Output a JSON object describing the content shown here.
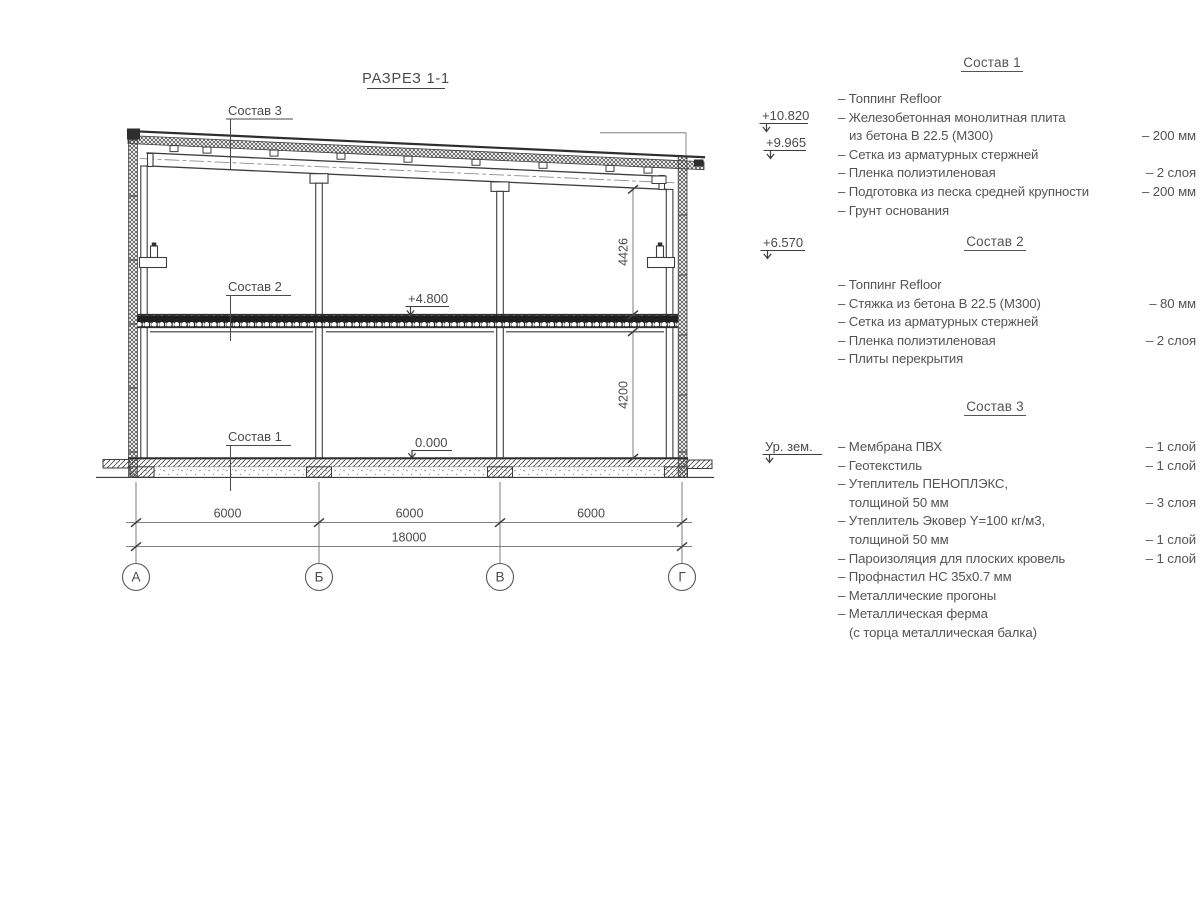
{
  "title": {
    "text": "РАЗРЕЗ 1-1"
  },
  "drawing": {
    "callouts": {
      "sostav3": "Состав 3",
      "sostav2": "Состав 2",
      "sostav1": "Состав 1"
    },
    "elevations": {
      "roof_high": "+10.820",
      "roof_low": "+9.965",
      "truss_support": "+6.570",
      "slab_top": "+4.800",
      "floor_zero": "0.000",
      "ground_level_label": "Ур. зем."
    },
    "dimensions": {
      "upper_height": "4426",
      "lower_height": "4200",
      "bay_1": "6000",
      "bay_2": "6000",
      "bay_3": "6000",
      "total": "18000"
    },
    "axes": {
      "a": "А",
      "b": "Б",
      "v": "В",
      "g": "Г"
    }
  },
  "legend": {
    "sections": [
      {
        "heading": "Состав 1",
        "rows": [
          {
            "text": "– Топпинг Refloor",
            "value": ""
          },
          {
            "text": "– Железобетонная монолитная плита",
            "value": ""
          },
          {
            "text": "из бетона В 22.5 (М300)",
            "value": "– 200 мм"
          },
          {
            "text": "– Сетка из арматурных стержней",
            "value": ""
          },
          {
            "text": "– Пленка полиэтиленовая",
            "value": "– 2 слоя"
          },
          {
            "text": "– Подготовка из песка средней крупности",
            "value": "– 200 мм"
          },
          {
            "text": "– Грунт основания",
            "value": ""
          }
        ]
      },
      {
        "heading": "Состав 2",
        "rows": [
          {
            "text": "– Топпинг Refloor",
            "value": ""
          },
          {
            "text": "– Стяжка из бетона В 22.5 (М300)",
            "value": "– 80 мм"
          },
          {
            "text": "– Сетка из арматурных стержней",
            "value": ""
          },
          {
            "text": "– Пленка полиэтиленовая",
            "value": "– 2 слоя"
          },
          {
            "text": "– Плиты перекрытия",
            "value": ""
          }
        ]
      },
      {
        "heading": "Состав 3",
        "rows": [
          {
            "text": "– Мембрана ПВХ",
            "value": "– 1 слой"
          },
          {
            "text": "– Геотекстиль",
            "value": "– 1 слой"
          },
          {
            "text": "– Утеплитель ПЕНОПЛЭКС,",
            "value": ""
          },
          {
            "text": "толщиной 50 мм",
            "value": "– 3 слоя"
          },
          {
            "text": "– Утеплитель Эковер Y=100 кг/м3,",
            "value": ""
          },
          {
            "text": "толщиной 50 мм",
            "value": "– 1 слой"
          },
          {
            "text": "– Пароизоляция для плоских кровель",
            "value": "– 1 слой"
          },
          {
            "text": "– Профнастил НС 35х0.7 мм",
            "value": ""
          },
          {
            "text": "– Металлические прогоны",
            "value": ""
          },
          {
            "text": "– Металлическая ферма",
            "value": ""
          },
          {
            "text": "(с торца металлическая балка)",
            "value": ""
          }
        ]
      }
    ]
  },
  "colors": {
    "line": "#3d3d3d",
    "thin_line": "#6e6e6e",
    "text": "#545454"
  }
}
